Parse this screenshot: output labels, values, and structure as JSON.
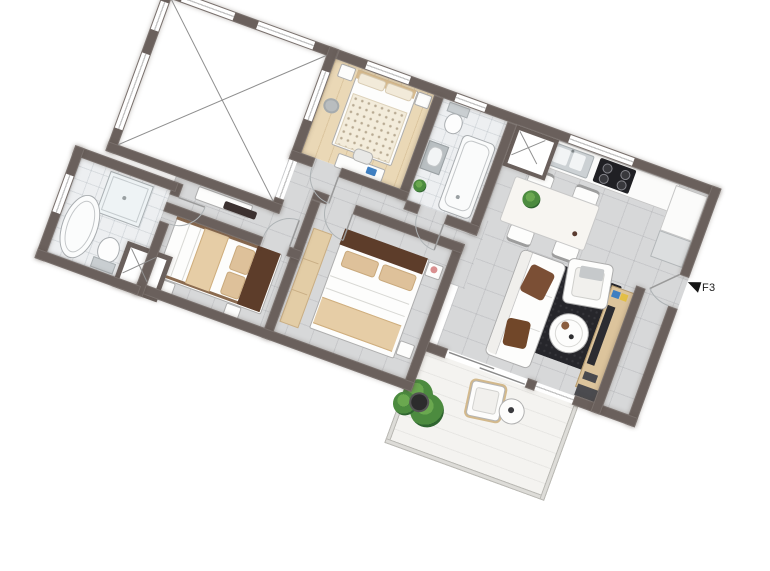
{
  "marker": {
    "label": "F3"
  },
  "colors": {
    "wall": "#6a605c",
    "tile": "#d7d8d9",
    "wood": "#ead8b6",
    "bath": "#edeff1",
    "balcony": "#f4f3f0",
    "rug": "#26262b",
    "cushion": "#7b4f35",
    "headboard": "#5d3d2a",
    "tan": "#dec19a",
    "wardrobe": "#e3cda6",
    "counter": "#fbfbfa",
    "stove": "#202024",
    "consoleWood": "#dcc49c",
    "plant": "#4c8b3f",
    "plantDark": "#2f6530",
    "blue": "#3f7fc1",
    "yellow": "#e3bf45",
    "pink": "#d98f8f",
    "dark": "#4b4b4f",
    "text": "#1a1a1a"
  },
  "plan": {
    "rotation_deg": 20,
    "rooms": [
      "terrace",
      "bedroom-top",
      "bathroom-top",
      "kitchen-dining",
      "living-room",
      "entry-hall",
      "bedroom-left",
      "bedroom-middle",
      "bathroom-left",
      "hallway",
      "balcony"
    ]
  }
}
